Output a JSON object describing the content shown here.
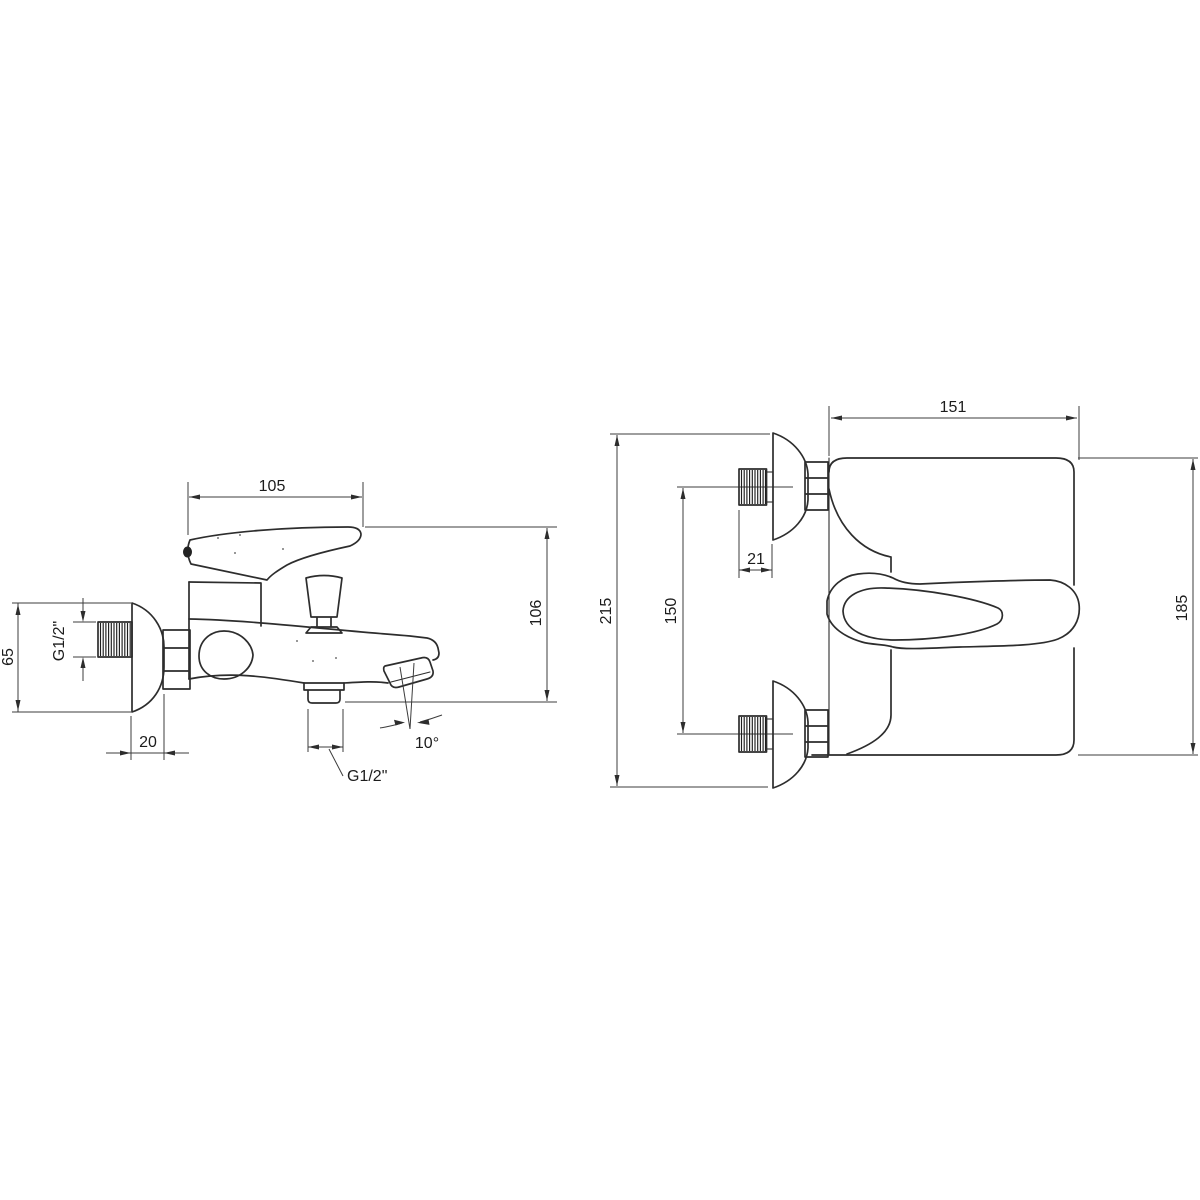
{
  "drawing": {
    "background": "#ffffff",
    "line_color": "#2d2d2d",
    "views": {
      "side": {
        "dims": {
          "handle_reach": "105",
          "body_height": "106",
          "escutcheon_diameter": "65",
          "inlet_thread": "G1/2\"",
          "escutcheon_depth": "20",
          "outlet_thread": "G1/2\"",
          "spout_angle": "10°"
        }
      },
      "front": {
        "dims": {
          "body_width": "151",
          "overall_height": "215",
          "inlet_centers": "150",
          "thread_length": "21",
          "body_side_height": "185"
        }
      }
    }
  }
}
